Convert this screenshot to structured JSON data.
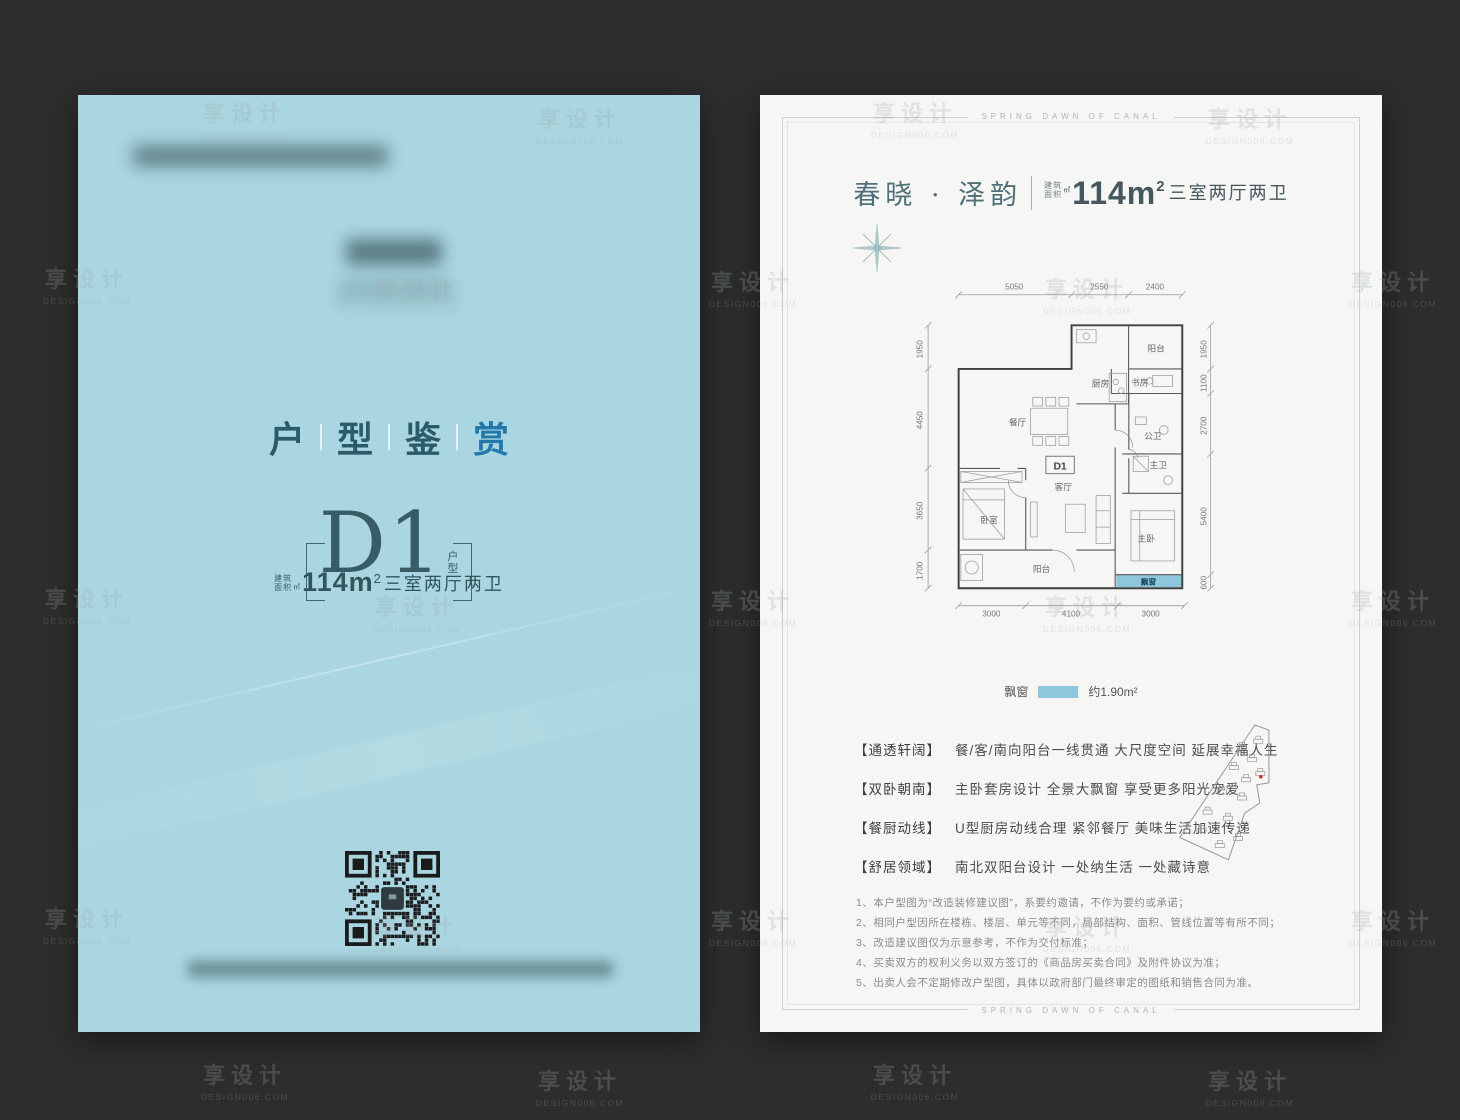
{
  "watermark": {
    "line1": "享设计",
    "line2": "DESIGN006.COM"
  },
  "left_page": {
    "title_chars": [
      "户",
      "型",
      "鉴",
      "赏"
    ],
    "unit_name": "D1",
    "unit_suffix": [
      "户",
      "型"
    ],
    "area_label": [
      "建筑",
      "面积"
    ],
    "area_unit": "㎡",
    "spec_num": "114m",
    "spec_sup": "2",
    "spec_rooms": "三室两厅两卫"
  },
  "right_page": {
    "border_text": "SPRING DAWN OF CANAL",
    "title": {
      "project": "春晓 · 泽韵",
      "area_label": [
        "建筑",
        "面积"
      ],
      "area_unit": "㎡",
      "area_num": "114m",
      "area_sup": "2",
      "rooms": "三室两厅两卫"
    },
    "legend": {
      "label": "飘窗",
      "value": "约1.90m²"
    },
    "features": [
      {
        "tag": "【通透轩阔】",
        "text": "餐/客/南向阳台一线贯通 大尺度空间 延展幸福人生"
      },
      {
        "tag": "【双卧朝南】",
        "text": "主卧套房设计 全景大飘窗 享受更多阳光宠爱"
      },
      {
        "tag": "【餐厨动线】",
        "text": "U型厨房动线合理 紧邻餐厅 美味生活加速传递"
      },
      {
        "tag": "【舒居领域】",
        "text": "南北双阳台设计 一处纳生活 一处藏诗意"
      }
    ],
    "disclaimers": [
      "1、本户型图为“改造装修建议图”，系要约邀请，不作为要约或承诺；",
      "2、相同户型因所在楼栋、楼层、单元等不同，局部结构、面积、管线位置等有所不同；",
      "3、改造建议图仅为示意参考，不作为交付标准；",
      "4、买卖双方的权利义务以双方签订的《商品房买卖合同》及附件协议为准；",
      "5、出卖人会不定期修改户型图，具体以政府部门最终审定的图纸和销售合同为准。"
    ],
    "floorplan": {
      "unit_label": "D1",
      "rooms": {
        "kitchen": "厨房",
        "balcony_top": "阳台",
        "study": "书房",
        "dining": "餐厅",
        "guest_bath": "公卫",
        "bedroom": "卧室",
        "living": "客厅",
        "master_bath": "主卫",
        "master_bedroom": "主卧",
        "balcony_bottom": "阳台",
        "bay_window": "飘窗"
      },
      "dims": {
        "top": [
          "5050",
          "2550",
          "2400"
        ],
        "left": [
          "1950",
          "4450",
          "3650",
          "1700"
        ],
        "right": [
          "1950",
          "1100",
          "2700",
          "5400",
          "600"
        ],
        "bottom": [
          "3000",
          "4100",
          "3000"
        ]
      }
    }
  },
  "colors": {
    "canvas_bg": "#2d2d2d",
    "left_page_bg": "#a9d6e0",
    "right_page_bg": "#f6f6f4",
    "accent_teal": "#385c64",
    "bright_blue": "#2278aa",
    "bay_window_blue": "#8ec6dd"
  }
}
